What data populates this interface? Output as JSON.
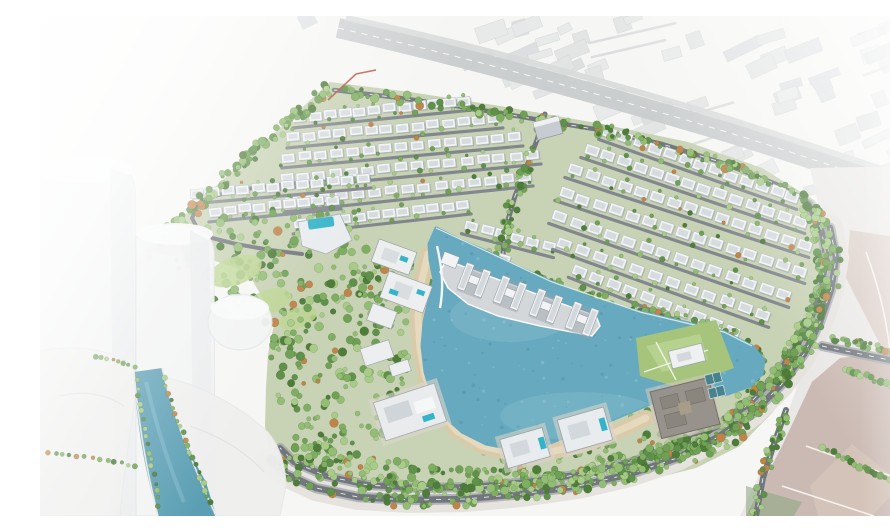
{
  "scene": {
    "description": "Aerial 3D masterplan rendering of a lakeside villa community surrounded by ring roads and greenery, with ghosted white context towers on the left and a faded existing city along the top",
    "lagoon_pier_building_count": 4,
    "ghost_tower_count": 3,
    "villa_district_count": 2
  },
  "colors": {
    "background": "#f6f6f4",
    "ghost_base": "#e9e8e6",
    "ghost_block": "#e3e5e5",
    "ghost_block_alt": "#dcdee0",
    "ghost_road": "#c9cccd",
    "site_base": "#c8d2b4",
    "ground_band": "#e6e3df",
    "lagoon": "#67a9bf",
    "lagoon_deep": "#4e8ca3",
    "lagoon_light": "#9fcbd8",
    "sand": "#d9cbaa",
    "sand_light": "#e8ddc2",
    "road": "#71777d",
    "road_minor": "#81878d",
    "road_line": "#f2f3f3",
    "sidewalk": "#9aa0a5",
    "villa_wall": "#f1f3f4",
    "villa_roof": "#d3d8dc",
    "villa_shadow": "#8f979e",
    "pier": "#d4d7d9",
    "pool": "#35b3c9",
    "lawn": "#a6c47c",
    "lawn_light": "#bcd592",
    "palace": "#97928b",
    "palace_dark": "#6f6b64",
    "court": "#47828e",
    "parcel_pink": "#cbbab3",
    "parcel_pink_light": "#d8c9c2",
    "tower": "#f2f3f3",
    "tower_edge": "#e2e4e5",
    "canal": "#5c9fb4",
    "boundary_red": "#b0442f"
  },
  "palette": {
    "trees": [
      "#4e7d3a",
      "#5f914a",
      "#6fa055",
      "#7fae62",
      "#93bd74",
      "#a8cc88"
    ],
    "tree_accent": "#c08449"
  }
}
